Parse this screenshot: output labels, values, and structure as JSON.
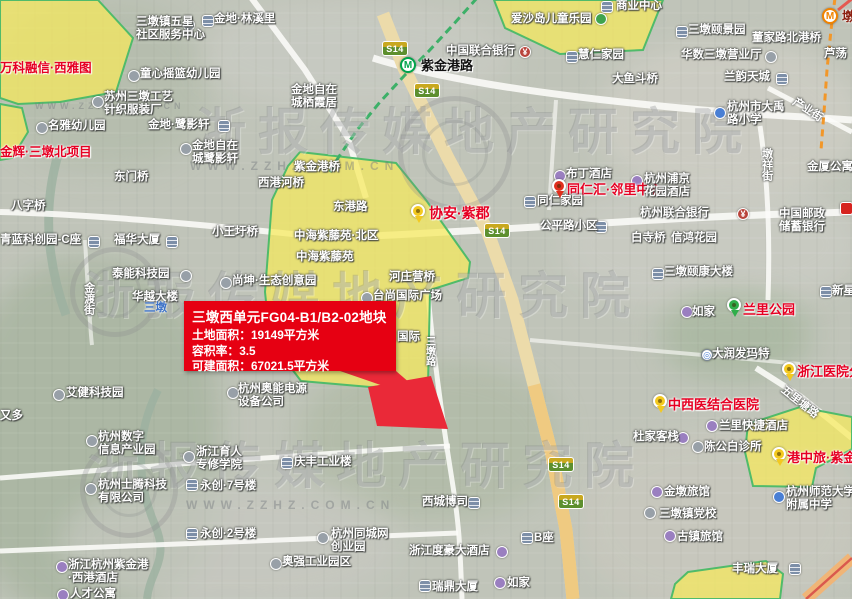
{
  "map": {
    "info_box": {
      "title": "三墩西单元FG04-B1/B2-02地块",
      "lines": [
        "土地面积：19149平方米",
        "容积率：3.5",
        "可建面积：67021.5平方米"
      ]
    },
    "watermark": {
      "brand": "浙报传媒地产研究院",
      "url": "WWW.ZZHZ.COM.CN"
    },
    "road_badge_label": "S14",
    "road_badges": [
      {
        "x": 382,
        "y": 41
      },
      {
        "x": 414,
        "y": 83
      },
      {
        "x": 484,
        "y": 223
      },
      {
        "x": 548,
        "y": 457
      },
      {
        "x": 558,
        "y": 494
      }
    ],
    "stations": [
      {
        "name": "紫金港路",
        "line": "green",
        "x": 400,
        "y": 57
      },
      {
        "name": "墩",
        "line": "orange",
        "x": 822,
        "y": 8
      }
    ],
    "labels": [
      {
        "t": "商业中心",
        "x": 616,
        "y": 0
      },
      {
        "t": "爱沙岛儿童乐园",
        "x": 511,
        "y": 13
      },
      {
        "t": "金地·林溪里",
        "x": 214,
        "y": 13
      },
      {
        "t": "三墩镇五星",
        "t2": "社区服务中心",
        "x": 136,
        "y": 16
      },
      {
        "t": "万科融信·西雅图",
        "x": 0,
        "y": 61,
        "s": "r"
      },
      {
        "t": "童心摇篮幼儿园",
        "x": 140,
        "y": 68
      },
      {
        "t": "苏州三墩工艺",
        "t2": "针织服装厂",
        "x": 104,
        "y": 91
      },
      {
        "t": "名雅幼儿园",
        "x": 48,
        "y": 120
      },
      {
        "t": "金地·鹭影轩",
        "x": 148,
        "y": 119
      },
      {
        "t": "金地自在",
        "t2": "城鹭影轩",
        "x": 192,
        "y": 140
      },
      {
        "t": "金辉·三墩北项目",
        "x": 0,
        "y": 145,
        "s": "r"
      },
      {
        "t": "金地自在",
        "t2": "城栖霞居",
        "x": 291,
        "y": 84
      },
      {
        "t": "三墩颐景园",
        "x": 688,
        "y": 24
      },
      {
        "t": "董家路北港桥",
        "x": 752,
        "y": 32
      },
      {
        "t": "慧仁家园",
        "x": 578,
        "y": 49
      },
      {
        "t": "华数三墩营业厅",
        "x": 681,
        "y": 49
      },
      {
        "t": "芦荡",
        "x": 824,
        "y": 48
      },
      {
        "t": "大鱼斗桥",
        "x": 612,
        "y": 73
      },
      {
        "t": "兰韵天城",
        "x": 724,
        "y": 71
      },
      {
        "t": "杭州市大禹",
        "t2": "路小学",
        "x": 727,
        "y": 101
      },
      {
        "t": "中国联合银行",
        "x": 446,
        "y": 45
      },
      {
        "t": "紫金港路",
        "x": 421,
        "y": 59,
        "s": "b"
      },
      {
        "t": "东门桥",
        "x": 114,
        "y": 171
      },
      {
        "t": "西港河桥",
        "x": 258,
        "y": 177
      },
      {
        "t": "八字桥",
        "x": 11,
        "y": 200
      },
      {
        "t": "青蓝科创园-C座",
        "x": 0,
        "y": 234
      },
      {
        "t": "福华大厦",
        "x": 114,
        "y": 234
      },
      {
        "t": "小王圩桥",
        "x": 212,
        "y": 226
      },
      {
        "t": "紫金港桥",
        "x": 294,
        "y": 161
      },
      {
        "t": "东港路",
        "x": 333,
        "y": 201
      },
      {
        "t": "中海紫藤苑·北区",
        "x": 294,
        "y": 230
      },
      {
        "t": "中海紫藤苑",
        "x": 296,
        "y": 251
      },
      {
        "t": "协安·紫郡",
        "x": 429,
        "y": 205,
        "s": "r",
        "fs": 14
      },
      {
        "t": "同仁汇·邻里中心",
        "x": 567,
        "y": 183,
        "s": "r",
        "fs": 13
      },
      {
        "t": "布丁酒店",
        "x": 566,
        "y": 168
      },
      {
        "t": "杭州浦京",
        "t2": "花园酒店",
        "x": 644,
        "y": 173
      },
      {
        "t": "同仁家园",
        "x": 537,
        "y": 195
      },
      {
        "t": "杭州联合银行",
        "x": 640,
        "y": 207
      },
      {
        "t": "公平路小区",
        "x": 540,
        "y": 220
      },
      {
        "t": "白寺桥",
        "x": 631,
        "y": 232
      },
      {
        "t": "信鸿花园",
        "x": 671,
        "y": 232
      },
      {
        "t": "中国邮政",
        "t2": "储蓄银行",
        "x": 779,
        "y": 208
      },
      {
        "t": "金厦公寓",
        "x": 807,
        "y": 161
      },
      {
        "t": "三墩颐康大楼",
        "x": 664,
        "y": 266
      },
      {
        "t": "新星",
        "x": 832,
        "y": 285
      },
      {
        "t": "尚坤·生态创意园",
        "x": 232,
        "y": 275
      },
      {
        "t": "泰能科技园",
        "x": 112,
        "y": 268
      },
      {
        "t": "华越大楼",
        "x": 132,
        "y": 291
      },
      {
        "t": "三墩",
        "x": 144,
        "y": 302,
        "s": "blue"
      },
      {
        "t": "艾健科技园",
        "x": 66,
        "y": 387
      },
      {
        "t": "又多",
        "x": 0,
        "y": 410
      },
      {
        "t": "杭州奥能电源",
        "t2": "设备公司",
        "x": 238,
        "y": 383
      },
      {
        "t": "河庄营桥",
        "x": 389,
        "y": 271
      },
      {
        "t": "台尚国际广场",
        "x": 373,
        "y": 290
      },
      {
        "t": "国际",
        "x": 397,
        "y": 331
      },
      {
        "t": "杭州数字",
        "t2": "信息产业园",
        "x": 98,
        "y": 431
      },
      {
        "t": "浙江育人",
        "t2": "专修学院",
        "x": 196,
        "y": 446
      },
      {
        "t": "永创·7号楼",
        "x": 200,
        "y": 480
      },
      {
        "t": "永创·2号楼",
        "x": 200,
        "y": 528
      },
      {
        "t": "杭州士腾科技",
        "t2": "有限公司",
        "x": 98,
        "y": 479
      },
      {
        "t": "浙江杭州紫金港",
        "t2": "·西港酒店",
        "x": 68,
        "y": 559
      },
      {
        "t": "人才公寓",
        "x": 70,
        "y": 588
      },
      {
        "t": "庆丰工业楼",
        "x": 294,
        "y": 456
      },
      {
        "t": "杭州同城网",
        "t2": "创业园",
        "x": 331,
        "y": 528
      },
      {
        "t": "奥强工业园区",
        "x": 282,
        "y": 556
      },
      {
        "t": "西城博司",
        "x": 422,
        "y": 496
      },
      {
        "t": "浙江度豪大酒店",
        "x": 409,
        "y": 545
      },
      {
        "t": "瑞鼎大厦",
        "x": 432,
        "y": 581
      },
      {
        "t": "如家",
        "x": 507,
        "y": 577
      },
      {
        "t": "B座",
        "x": 534,
        "y": 532
      },
      {
        "t": "兰里公园",
        "x": 743,
        "y": 303,
        "s": "r",
        "fs": 13
      },
      {
        "t": "如家",
        "x": 692,
        "y": 306
      },
      {
        "t": "大润发玛特",
        "x": 712,
        "y": 348
      },
      {
        "t": "浙江医院分",
        "x": 797,
        "y": 365,
        "s": "r",
        "fs": 13
      },
      {
        "t": "中西医结合医院",
        "x": 668,
        "y": 398,
        "s": "r",
        "fs": 13
      },
      {
        "t": "兰里快捷酒店",
        "x": 719,
        "y": 420
      },
      {
        "t": "杜家客栈",
        "x": 633,
        "y": 431
      },
      {
        "t": "陈公白诊所",
        "x": 704,
        "y": 441
      },
      {
        "t": "港中旅·紫金",
        "x": 787,
        "y": 451,
        "s": "r",
        "fs": 13
      },
      {
        "t": "杭州师范大学",
        "t2": "附属中学",
        "x": 786,
        "y": 486
      },
      {
        "t": "金墩旅馆",
        "x": 664,
        "y": 486
      },
      {
        "t": "三墩镇党校",
        "x": 659,
        "y": 508
      },
      {
        "t": "古镇旅馆",
        "x": 677,
        "y": 531
      },
      {
        "t": "丰瑞大厦",
        "x": 732,
        "y": 563
      },
      {
        "t": "金渡街",
        "x": 82,
        "y": 282,
        "s": "road",
        "rot": 90
      },
      {
        "t": "三墩路",
        "x": 423,
        "y": 336,
        "s": "road",
        "rot": 90,
        "fs": 10
      },
      {
        "t": "墩祥街",
        "x": 760,
        "y": 148,
        "s": "road",
        "rot": 90
      },
      {
        "t": "五里塘路",
        "x": 786,
        "y": 384,
        "s": "road",
        "rot": 38
      },
      {
        "t": "产业街",
        "x": 797,
        "y": 96,
        "s": "road",
        "rot": 33
      },
      {
        "t": "墩",
        "x": 842,
        "y": 10,
        "s": "station-orange"
      }
    ],
    "icons": [
      {
        "k": "building",
        "x": 601,
        "y": 1
      },
      {
        "k": "park",
        "x": 595,
        "y": 13
      },
      {
        "k": "building",
        "x": 202,
        "y": 15
      },
      {
        "k": "dot",
        "x": 183,
        "y": 19
      },
      {
        "k": "dot",
        "x": 128,
        "y": 70
      },
      {
        "k": "dot",
        "x": 92,
        "y": 96
      },
      {
        "k": "dot",
        "x": 36,
        "y": 122
      },
      {
        "k": "building",
        "x": 218,
        "y": 120
      },
      {
        "k": "dot",
        "x": 180,
        "y": 143
      },
      {
        "k": "building",
        "x": 676,
        "y": 26
      },
      {
        "k": "building",
        "x": 566,
        "y": 51
      },
      {
        "k": "dot",
        "x": 765,
        "y": 51
      },
      {
        "k": "building",
        "x": 776,
        "y": 73
      },
      {
        "k": "school",
        "x": 714,
        "y": 107
      },
      {
        "k": "bank",
        "x": 519,
        "y": 46
      },
      {
        "k": "building",
        "x": 88,
        "y": 236
      },
      {
        "k": "building",
        "x": 166,
        "y": 236
      },
      {
        "k": "pin-yellow",
        "x": 411,
        "y": 204
      },
      {
        "k": "pin-red",
        "x": 552,
        "y": 179
      },
      {
        "k": "hotel",
        "x": 554,
        "y": 170
      },
      {
        "k": "hotel",
        "x": 631,
        "y": 175
      },
      {
        "k": "building",
        "x": 524,
        "y": 196
      },
      {
        "k": "bank",
        "x": 737,
        "y": 208
      },
      {
        "k": "building",
        "x": 595,
        "y": 221
      },
      {
        "k": "building",
        "x": 652,
        "y": 268
      },
      {
        "k": "building",
        "x": 820,
        "y": 286
      },
      {
        "k": "dot",
        "x": 220,
        "y": 277
      },
      {
        "k": "dot",
        "x": 180,
        "y": 270
      },
      {
        "k": "dot",
        "x": 53,
        "y": 389
      },
      {
        "k": "dot",
        "x": 227,
        "y": 387
      },
      {
        "k": "dot",
        "x": 361,
        "y": 292
      },
      {
        "k": "dot",
        "x": 86,
        "y": 435
      },
      {
        "k": "dot",
        "x": 183,
        "y": 451
      },
      {
        "k": "building",
        "x": 186,
        "y": 479
      },
      {
        "k": "building",
        "x": 186,
        "y": 528
      },
      {
        "k": "dot",
        "x": 85,
        "y": 483
      },
      {
        "k": "hotel",
        "x": 56,
        "y": 561
      },
      {
        "k": "hotel",
        "x": 57,
        "y": 589
      },
      {
        "k": "building",
        "x": 281,
        "y": 457
      },
      {
        "k": "dot",
        "x": 317,
        "y": 532
      },
      {
        "k": "dot",
        "x": 270,
        "y": 558
      },
      {
        "k": "building",
        "x": 468,
        "y": 497
      },
      {
        "k": "hotel",
        "x": 496,
        "y": 546
      },
      {
        "k": "building",
        "x": 419,
        "y": 580
      },
      {
        "k": "hotel",
        "x": 494,
        "y": 577
      },
      {
        "k": "building",
        "x": 521,
        "y": 532
      },
      {
        "k": "pin-green",
        "x": 727,
        "y": 298
      },
      {
        "k": "hotel",
        "x": 681,
        "y": 306
      },
      {
        "k": "white-dot",
        "x": 701,
        "y": 349
      },
      {
        "k": "pin-yellow",
        "x": 782,
        "y": 362
      },
      {
        "k": "pin-yellow",
        "x": 653,
        "y": 394
      },
      {
        "k": "hotel",
        "x": 706,
        "y": 420
      },
      {
        "k": "hotel",
        "x": 677,
        "y": 432
      },
      {
        "k": "dot",
        "x": 692,
        "y": 441
      },
      {
        "k": "pin-yellow",
        "x": 772,
        "y": 447
      },
      {
        "k": "school",
        "x": 773,
        "y": 491
      },
      {
        "k": "hotel",
        "x": 651,
        "y": 486
      },
      {
        "k": "dot",
        "x": 644,
        "y": 507
      },
      {
        "k": "hotel",
        "x": 664,
        "y": 530
      },
      {
        "k": "building",
        "x": 789,
        "y": 563
      },
      {
        "k": "red-badge",
        "x": 840,
        "y": 202
      }
    ]
  }
}
